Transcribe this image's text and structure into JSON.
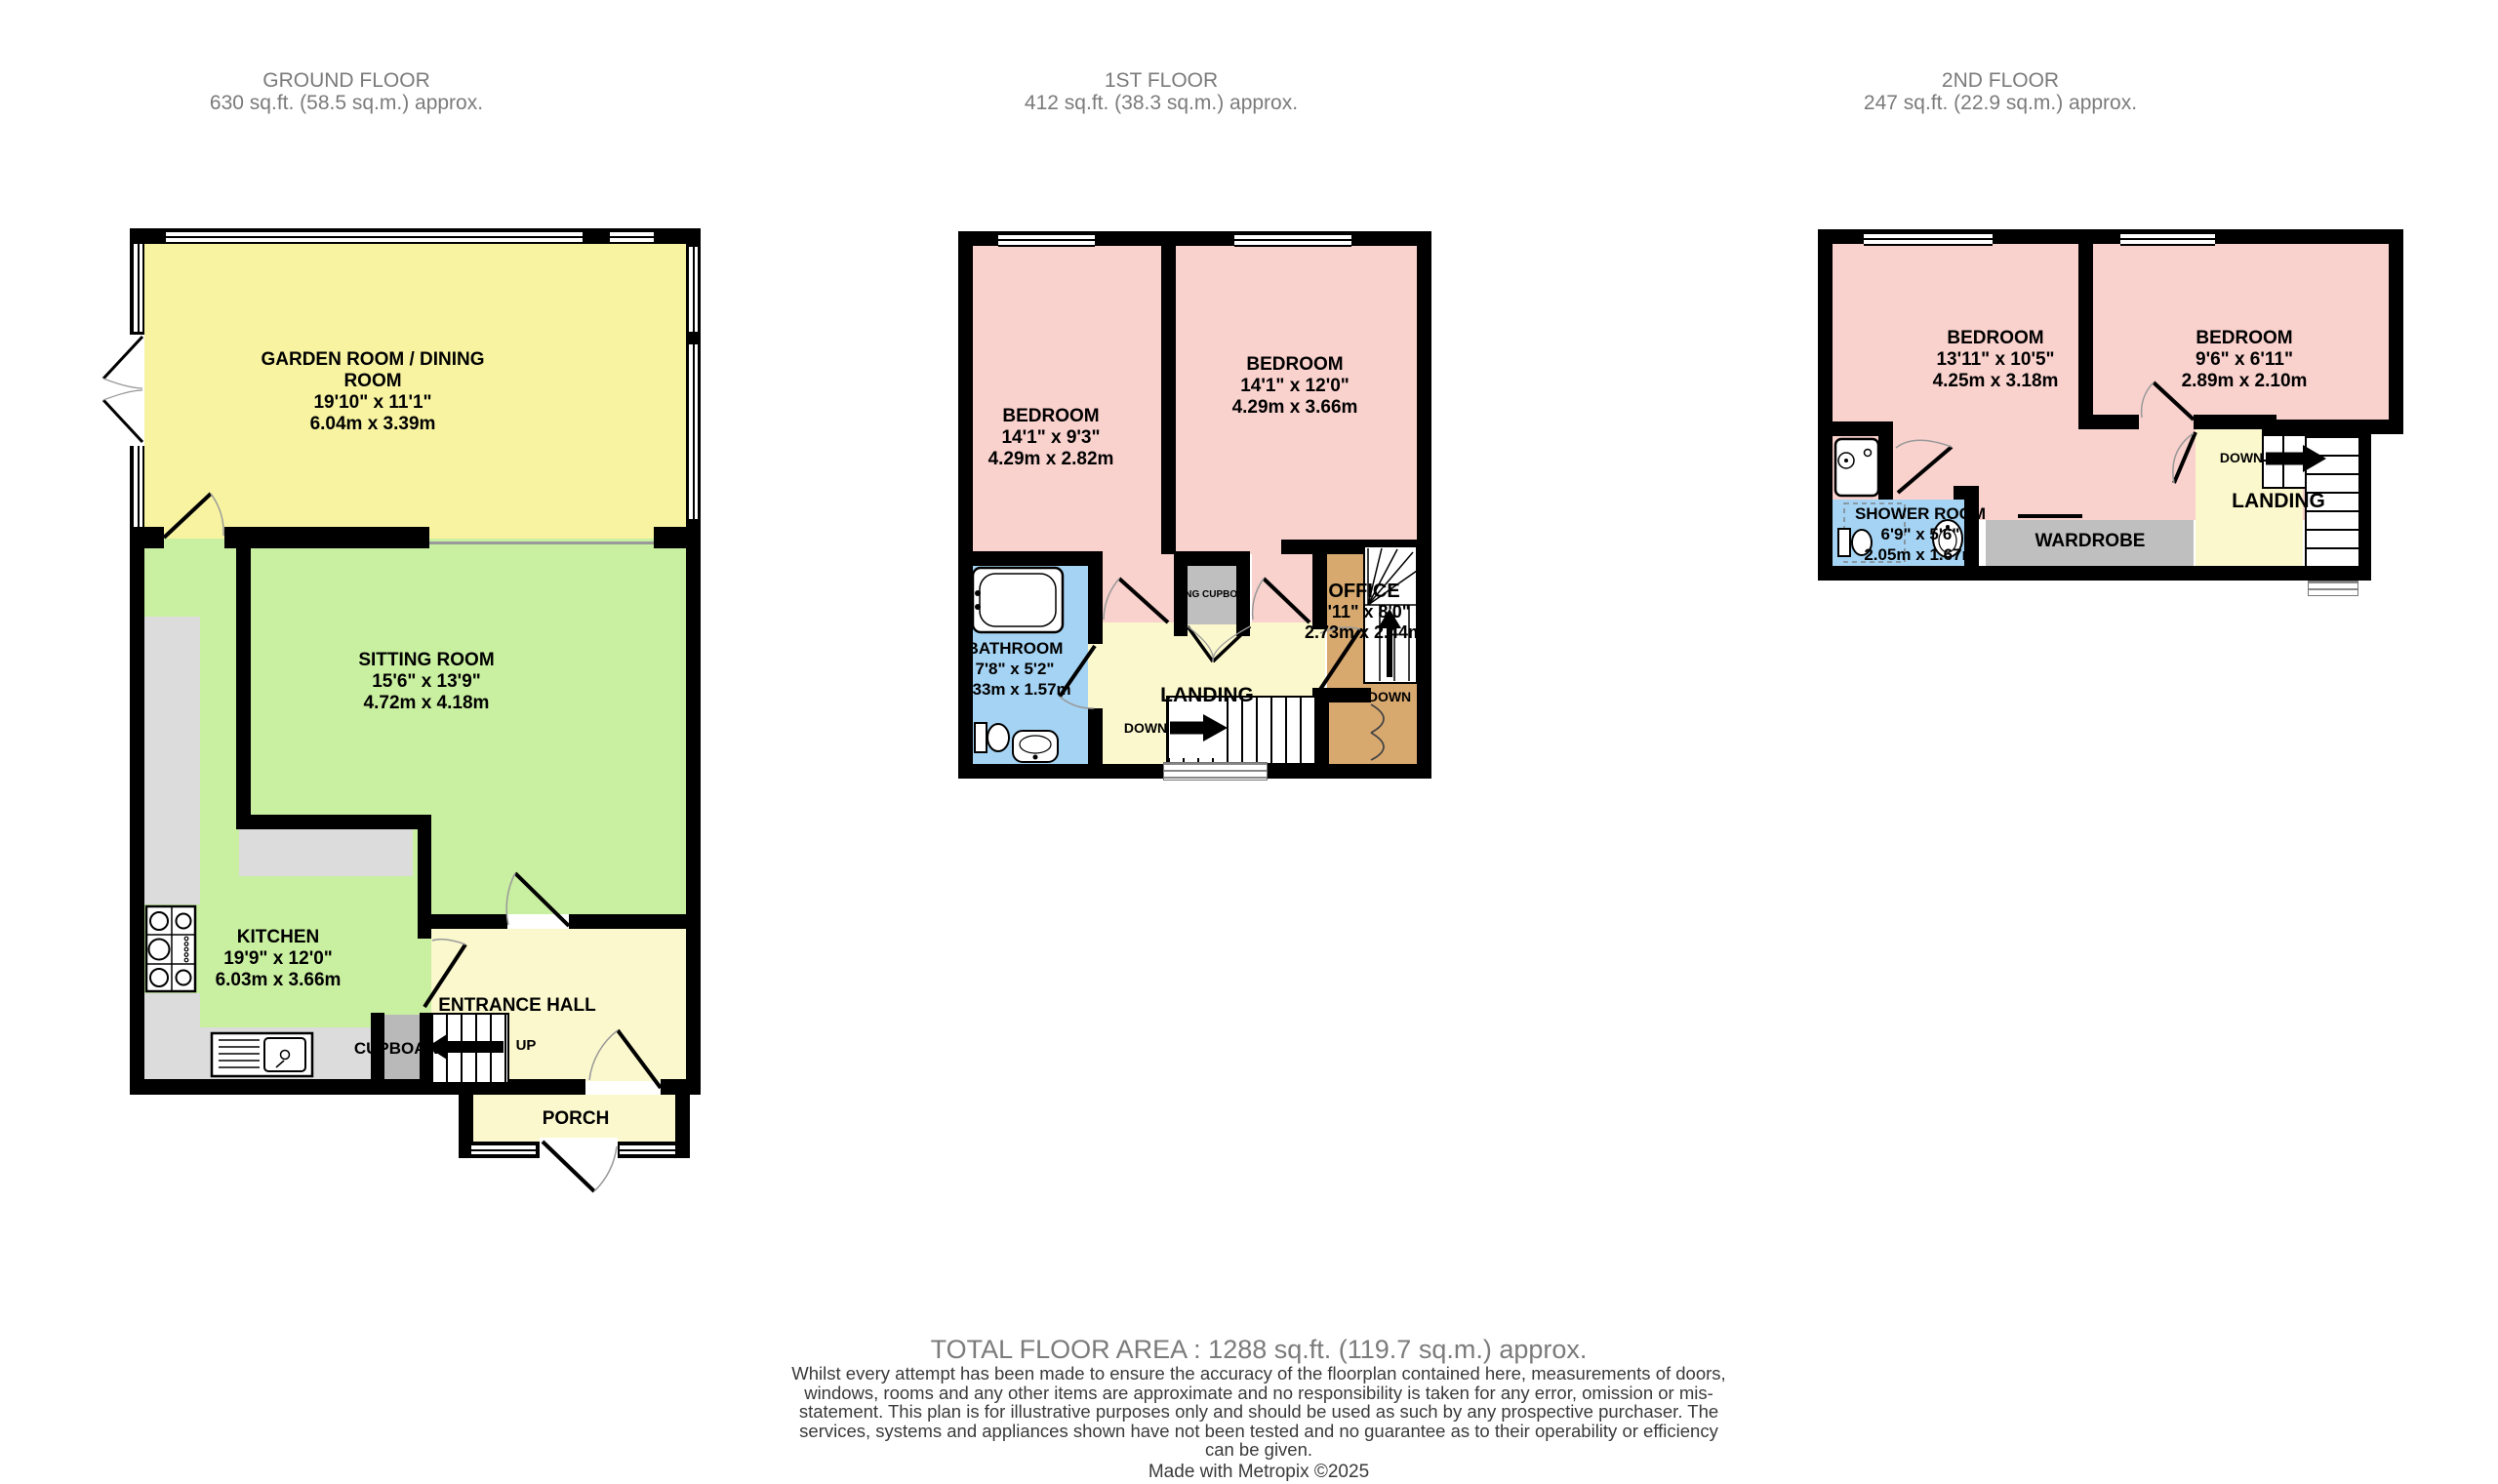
{
  "document_type": "property floorplan",
  "colors": {
    "yellow_room": "#f7f3a1",
    "pale_yellow_room": "#fbf8cd",
    "green_room": "#c9efa0",
    "pink_room": "#f9d1cd",
    "blue_room": "#a5d3f3",
    "tan_room": "#d8a96f",
    "counter_gray": "#dcdcdc",
    "storage_gray": "#bdbdbd",
    "wall_black": "#000000",
    "header_gray": "#7b7b7b",
    "disclaimer_gray": "#3a3a3a"
  },
  "floors": {
    "ground": {
      "title": "GROUND FLOOR",
      "area": "630 sq.ft. (58.5 sq.m.) approx.",
      "garden_room": {
        "l1": "GARDEN ROOM / DINING",
        "l2": "ROOM",
        "l3": "19'10\"  x 11'1\"",
        "l4": "6.04m  x 3.39m"
      },
      "sitting_room": {
        "l1": "SITTING ROOM",
        "l2": "15'6\"  x 13'9\"",
        "l3": "4.72m  x 4.18m"
      },
      "kitchen": {
        "l1": "KITCHEN",
        "l2": "19'9\"  x 12'0\"",
        "l3": "6.03m  x 3.66m"
      },
      "entrance_hall": "ENTRANCE HALL",
      "cupboard": "CUPBOARD",
      "porch": "PORCH",
      "up": "UP"
    },
    "first": {
      "title": "1ST FLOOR",
      "area": "412 sq.ft. (38.3 sq.m.) approx.",
      "bedroom_left": {
        "l1": "BEDROOM",
        "l2": "14'1\"  x 9'3\"",
        "l3": "4.29m  x 2.82m"
      },
      "bedroom_right": {
        "l1": "BEDROOM",
        "l2": "14'1\"  x 12'0\"",
        "l3": "4.29m  x 3.66m"
      },
      "bathroom": {
        "l1": "BATHROOM",
        "l2": "7'8\"  x 5'2\"",
        "l3": "2.33m  x 1.57m"
      },
      "office": {
        "l1": "OFFICE",
        "l2": "8'11\"  x 8'0\"",
        "l3": "2.73m  x 2.44m"
      },
      "airing_cupboard": "AIRING CUPBOARD",
      "landing": "LANDING",
      "down": "DOWN"
    },
    "second": {
      "title": "2ND FLOOR",
      "area": "247 sq.ft. (22.9 sq.m.) approx.",
      "bedroom_left": {
        "l1": "BEDROOM",
        "l2": "13'11\"  x 10'5\"",
        "l3": "4.25m  x 3.18m"
      },
      "bedroom_right": {
        "l1": "BEDROOM",
        "l2": "9'6\"  x 6'11\"",
        "l3": "2.89m  x 2.10m"
      },
      "shower_room": {
        "l1": "SHOWER ROOM",
        "l2": "6'9\"  x 5'6\"",
        "l3": "2.05m  x 1.67m"
      },
      "wardrobe": "WARDROBE",
      "landing": "LANDING",
      "down": "DOWN"
    }
  },
  "footer": {
    "total": "TOTAL FLOOR AREA : 1288 sq.ft. (119.7 sq.m.) approx.",
    "disclaimer": "Whilst every attempt has been made to ensure the accuracy of the floorplan contained here, measurements of doors, windows, rooms and any other items are approximate and no responsibility is taken for any error, omission or mis-statement. This plan is for illustrative purposes only and should be used as such by any prospective purchaser. The services, systems and appliances shown have not been tested and no guarantee as to their operability or efficiency can be given.",
    "credit": "Made with Metropix ©2025"
  }
}
